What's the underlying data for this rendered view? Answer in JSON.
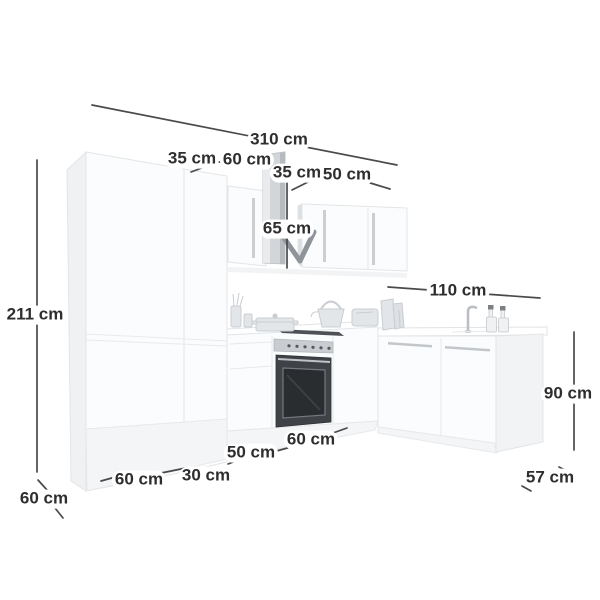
{
  "diagram": {
    "title": "L-shaped kitchen unit dimension diagram",
    "unit": "cm",
    "colors": {
      "background": "#ffffff",
      "dimension_line": "#4a4a4a",
      "label_text": "#2e2e2e",
      "cabinet_fill": "#fbfcfd",
      "cabinet_edge": "#e2e5e7",
      "hood_chimney": "#d3d6d9",
      "hood_canopy": "#8e9499",
      "oven_dark": "#3f4347"
    }
  },
  "measurements": [
    {
      "id": "total-width",
      "text": "310 cm",
      "value": 310,
      "x": 279,
      "y": 140
    },
    {
      "id": "tall-divider-35",
      "text": "35 cm",
      "value": 35,
      "x": 192,
      "y": 159
    },
    {
      "id": "wall-cabinet-60",
      "text": "60 cm",
      "value": 60,
      "x": 247,
      "y": 160
    },
    {
      "id": "wall-cabinet-35",
      "text": "35 cm",
      "value": 35,
      "x": 297,
      "y": 173
    },
    {
      "id": "wall-cabinet-50",
      "text": "50 cm",
      "value": 50,
      "x": 347,
      "y": 175
    },
    {
      "id": "hood-height-65",
      "text": "65 cm",
      "value": 65,
      "x": 287,
      "y": 229
    },
    {
      "id": "right-run-110",
      "text": "110 cm",
      "value": 110,
      "x": 458,
      "y": 291
    },
    {
      "id": "total-height-211",
      "text": "211 cm",
      "value": 211,
      "x": 35,
      "y": 315
    },
    {
      "id": "worktop-height-90",
      "text": "90 cm",
      "value": 90,
      "x": 568,
      "y": 394
    },
    {
      "id": "base-cabinet-60",
      "text": "60 cm",
      "value": 60,
      "x": 311,
      "y": 440
    },
    {
      "id": "base-cabinet-50",
      "text": "50 cm",
      "value": 50,
      "x": 251,
      "y": 453
    },
    {
      "id": "tall-cabinet-30",
      "text": "30 cm",
      "value": 30,
      "x": 206,
      "y": 476
    },
    {
      "id": "tall-cabinet-60",
      "text": "60 cm",
      "value": 60,
      "x": 139,
      "y": 480
    },
    {
      "id": "left-depth-60",
      "text": "60 cm",
      "value": 60,
      "x": 44,
      "y": 499
    },
    {
      "id": "right-depth-57",
      "text": "57 cm",
      "value": 57,
      "x": 550,
      "y": 478
    }
  ]
}
